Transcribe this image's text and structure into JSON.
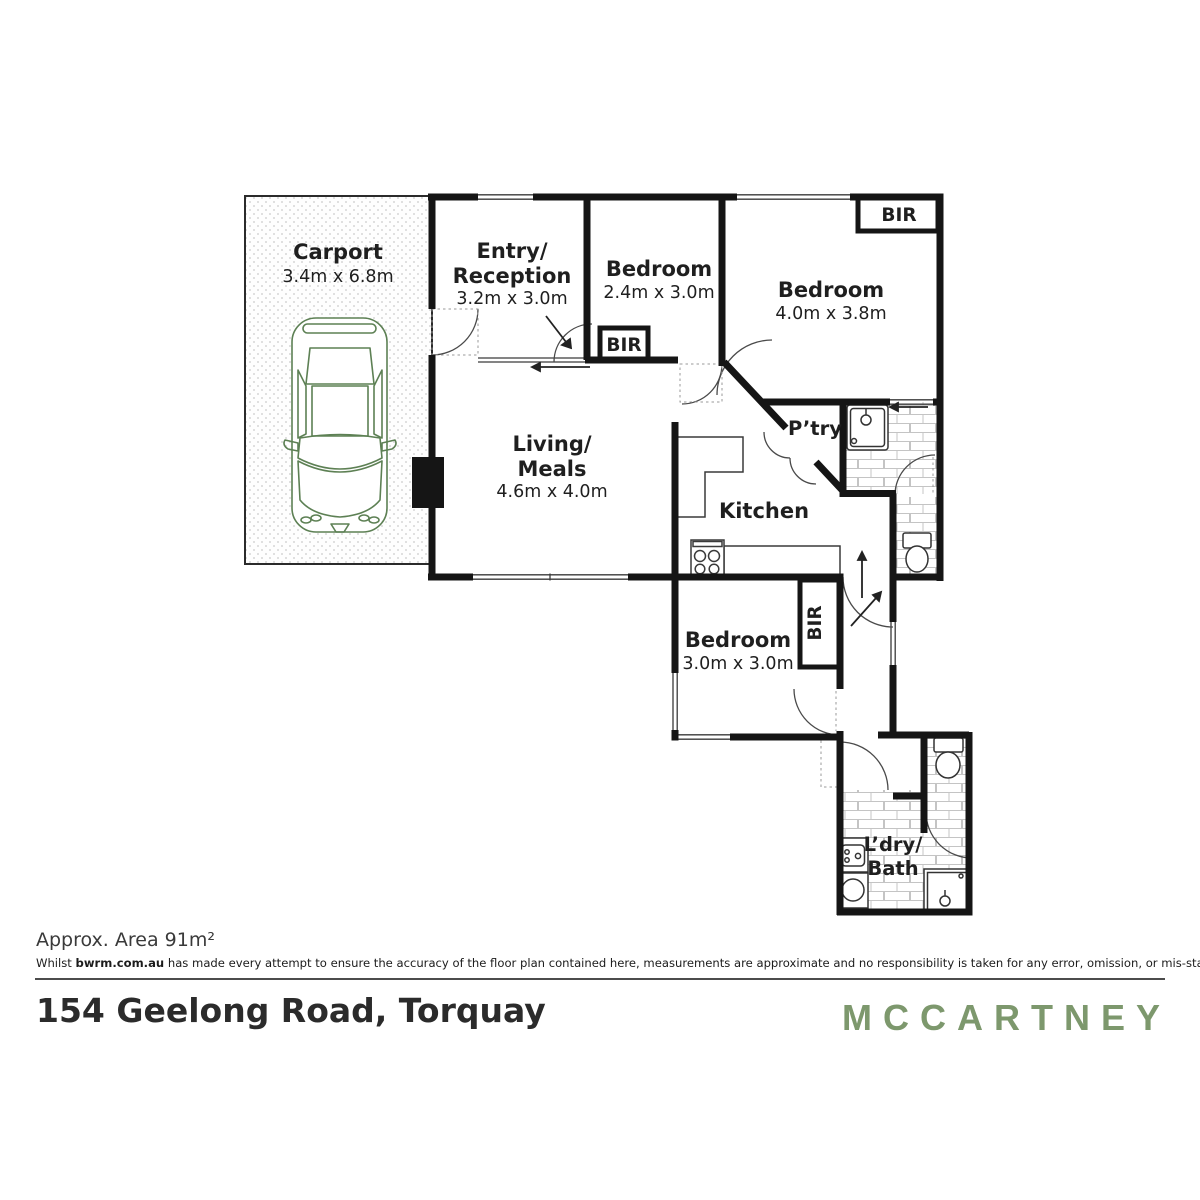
{
  "plan": {
    "carport": {
      "name": "Carport",
      "dims": "3.4m x 6.8m"
    },
    "entry": {
      "line1": "Entry/",
      "line2": "Reception",
      "dims": "3.2m x 3.0m"
    },
    "bed1": {
      "name": "Bedroom",
      "dims": "2.4m x 3.0m"
    },
    "bed2": {
      "name": "Bedroom",
      "dims": "4.0m x 3.8m"
    },
    "living": {
      "line1": "Living/",
      "line2": "Meals",
      "dims": "4.6m x 4.0m"
    },
    "kitchen": {
      "name": "Kitchen"
    },
    "pantry": {
      "name": "P’try"
    },
    "bed3": {
      "name": "Bedroom",
      "dims": "3.0m x 3.0m"
    },
    "laundry": {
      "line1": "L’dry/",
      "line2": "Bath"
    },
    "bir": "BIR"
  },
  "footer": {
    "area": "Approx. Area 91m²",
    "disclaimer_prefix": "Whilst ",
    "disclaimer_bold": "bwrm.com.au",
    "disclaimer_rest": " has made every attempt to ensure the accuracy of the floor plan contained here, measurements are approximate and no responsibility is taken for any error, omission, or mis-statement. This plan is for illustrative purposes only.",
    "address": "154 Geelong Road, Torquay",
    "brand": "MCCARTNEY"
  },
  "colors": {
    "brand_green": "#7d986d",
    "car_green": "#5d8054",
    "wall_black": "#151515",
    "tile_line": "#c4c4c4"
  }
}
